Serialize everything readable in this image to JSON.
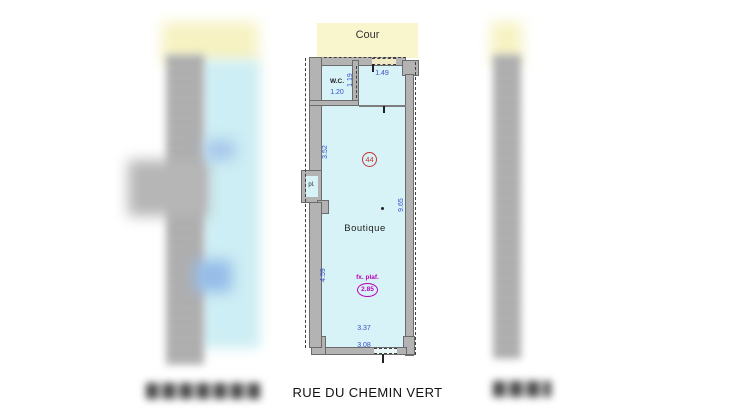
{
  "plan": {
    "street_label": "RUE DU CHEMIN VERT",
    "courtyard_label": "Cour",
    "room_label": "Boutique",
    "wc_label": "W.C.",
    "closet_label": "pl.",
    "lot_number": "44",
    "ceiling": {
      "label": "fx. plaf.",
      "value": "2.85"
    },
    "dimensions": {
      "cour_door_width": "1.49",
      "wc_width": "1.20",
      "wc_depth": "1.19",
      "left_upper": "3.52",
      "left_lower": "4.59",
      "right_depth": "9.65",
      "rear_width": "3.37",
      "front_width": "3.08"
    }
  },
  "colors": {
    "interior": "#d8f3f8",
    "courtyard": "#f9f5cd",
    "wall": "#b3b3b3",
    "dimension_text": "#3750c8",
    "lot_number": "#c43434",
    "ceiling_text": "#b800b8"
  }
}
